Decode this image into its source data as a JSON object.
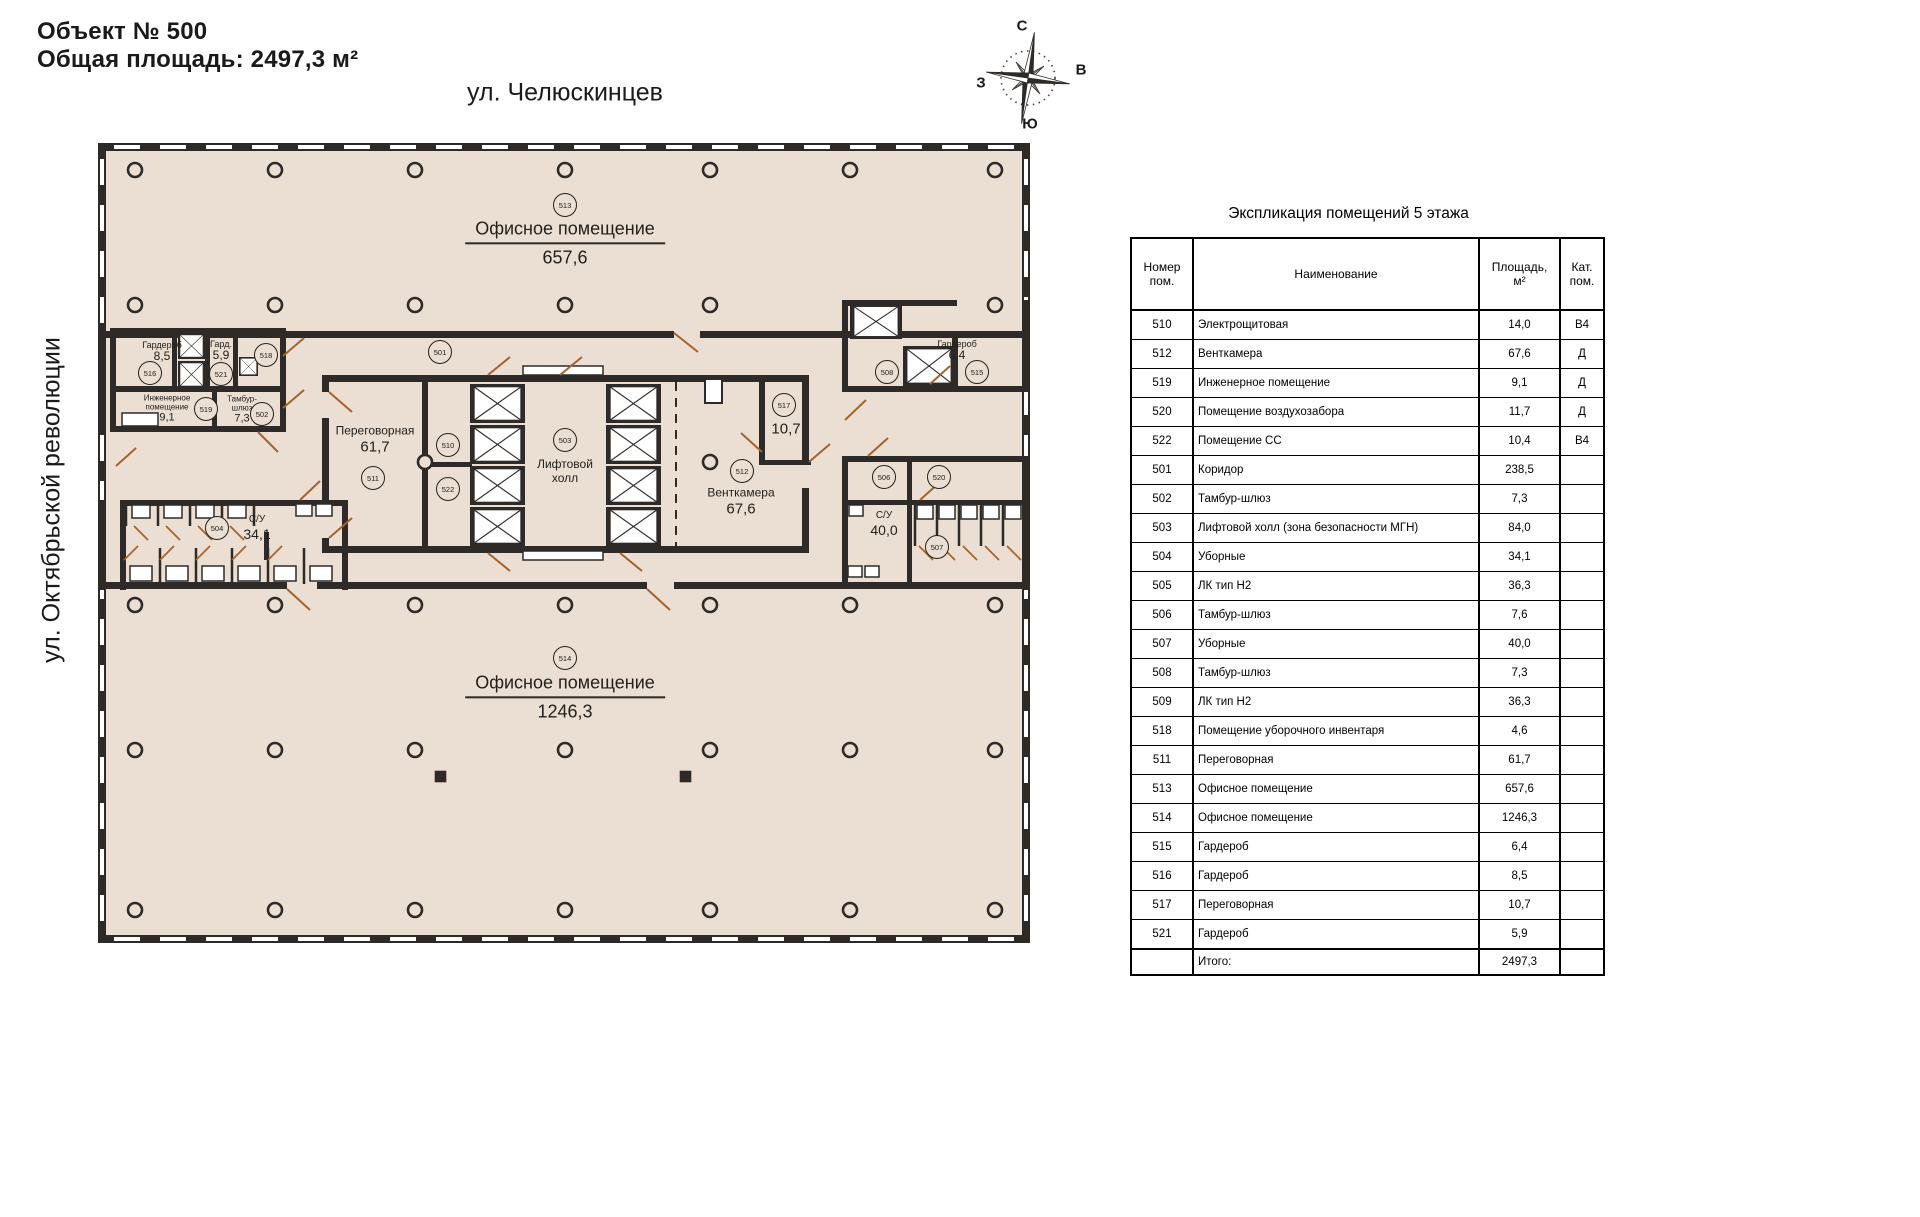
{
  "colors": {
    "floor": "#EADFD2",
    "wall": "#2E2A27",
    "door": "#A6622B",
    "paper": "#FFFFFF"
  },
  "header": {
    "title": "Объект № 500",
    "subtitle": "Общая площадь: 2497,3 м²"
  },
  "streets": {
    "top": "ул. Челюскинцев",
    "left": "ул. Октябрьской революции"
  },
  "compass": {
    "n": "С",
    "s": "Ю",
    "w": "З",
    "e": "В"
  },
  "plan": {
    "labels": [
      {
        "id": "513",
        "kind": "office",
        "x": 565,
        "y": 243,
        "name": "Офисное помещение",
        "area": "657,6",
        "underline": true
      },
      {
        "id": "514",
        "kind": "office",
        "x": 565,
        "y": 697,
        "name": "Офисное помещение",
        "area": "1246,3",
        "underline": true
      },
      {
        "id": "511",
        "kind": "room",
        "x": 375,
        "y": 440,
        "name": "Переговорная",
        "area": "61,7"
      },
      {
        "id": "503",
        "kind": "room",
        "x": 565,
        "y": 472,
        "name": "Лифтовой\nхолл"
      },
      {
        "id": "512",
        "kind": "room",
        "x": 741,
        "y": 502,
        "name": "Венткамера",
        "area": "67,6"
      },
      {
        "id": "517",
        "kind": "room",
        "x": 786,
        "y": 429,
        "area": "10,7"
      },
      {
        "id": "516",
        "kind": "tiny",
        "x": 162,
        "y": 352,
        "name": "Гардероб",
        "area": "8,5"
      },
      {
        "id": "521",
        "kind": "tiny",
        "x": 221,
        "y": 351,
        "name": "Гард.",
        "area": "5,9"
      },
      {
        "id": "519",
        "kind": "tiny2",
        "x": 167,
        "y": 409,
        "name": "Инженерное\nпомещение",
        "area": "9,1"
      },
      {
        "id": "502",
        "kind": "tiny2",
        "x": 242,
        "y": 410,
        "name": "Тамбур-\nшлюз",
        "area": "7,3"
      },
      {
        "id": "504",
        "kind": "small",
        "x": 257,
        "y": 528,
        "name": "С/У",
        "area": "34,1"
      },
      {
        "id": "507",
        "kind": "small",
        "x": 884,
        "y": 524,
        "name": "С/У",
        "area": "40,0"
      },
      {
        "id": "515",
        "kind": "tiny",
        "x": 957,
        "y": 351,
        "name": "Гардероб",
        "area": "6,4"
      }
    ],
    "badges": [
      {
        "num": "513",
        "x": 565,
        "y": 205
      },
      {
        "num": "514",
        "x": 565,
        "y": 658
      },
      {
        "num": "501",
        "x": 440,
        "y": 352
      },
      {
        "num": "511",
        "x": 373,
        "y": 478
      },
      {
        "num": "510",
        "x": 448,
        "y": 445
      },
      {
        "num": "522",
        "x": 448,
        "y": 489
      },
      {
        "num": "503",
        "x": 565,
        "y": 440
      },
      {
        "num": "512",
        "x": 742,
        "y": 471
      },
      {
        "num": "517",
        "x": 784,
        "y": 405
      },
      {
        "num": "516",
        "x": 150,
        "y": 373
      },
      {
        "num": "521",
        "x": 221,
        "y": 374
      },
      {
        "num": "518",
        "x": 266,
        "y": 355
      },
      {
        "num": "519",
        "x": 206,
        "y": 409
      },
      {
        "num": "502",
        "x": 262,
        "y": 414
      },
      {
        "num": "504",
        "x": 217,
        "y": 528
      },
      {
        "num": "506",
        "x": 884,
        "y": 477
      },
      {
        "num": "520",
        "x": 939,
        "y": 477
      },
      {
        "num": "507",
        "x": 937,
        "y": 547
      },
      {
        "num": "508",
        "x": 887,
        "y": 372
      },
      {
        "num": "515",
        "x": 977,
        "y": 372
      }
    ]
  },
  "table": {
    "title": "Экспликация помещений 5 этажа",
    "columns": {
      "num": "Номер\nпом.",
      "name": "Наименование",
      "area": "Площадь, м²",
      "cat": "Кат.\nпом."
    },
    "rows": [
      {
        "num": "510",
        "name": "Электрощитовая",
        "area": "14,0",
        "cat": "В4"
      },
      {
        "num": "512",
        "name": "Венткамера",
        "area": "67,6",
        "cat": "Д"
      },
      {
        "num": "519",
        "name": "Инженерное помещение",
        "area": "9,1",
        "cat": "Д"
      },
      {
        "num": "520",
        "name": "Помещение воздухозабора",
        "area": "11,7",
        "cat": "Д"
      },
      {
        "num": "522",
        "name": "Помещение СС",
        "area": "10,4",
        "cat": "В4"
      },
      {
        "num": "501",
        "name": "Коридор",
        "area": "238,5",
        "cat": ""
      },
      {
        "num": "502",
        "name": "Тамбур-шлюз",
        "area": "7,3",
        "cat": ""
      },
      {
        "num": "503",
        "name": "Лифтовой холл (зона безопасности МГН)",
        "area": "84,0",
        "cat": ""
      },
      {
        "num": "504",
        "name": "Уборные",
        "area": "34,1",
        "cat": ""
      },
      {
        "num": "505",
        "name": "ЛК тип Н2",
        "area": "36,3",
        "cat": ""
      },
      {
        "num": "506",
        "name": "Тамбур-шлюз",
        "area": "7,6",
        "cat": ""
      },
      {
        "num": "507",
        "name": "Уборные",
        "area": "40,0",
        "cat": ""
      },
      {
        "num": "508",
        "name": "Тамбур-шлюз",
        "area": "7,3",
        "cat": ""
      },
      {
        "num": "509",
        "name": "ЛК тип Н2",
        "area": "36,3",
        "cat": ""
      },
      {
        "num": "518",
        "name": "Помещение уборочного инвентаря",
        "area": "4,6",
        "cat": ""
      },
      {
        "num": "511",
        "name": "Переговорная",
        "area": "61,7",
        "cat": ""
      },
      {
        "num": "513",
        "name": "Офисное помещение",
        "area": "657,6",
        "cat": ""
      },
      {
        "num": "514",
        "name": "Офисное помещение",
        "area": "1246,3",
        "cat": ""
      },
      {
        "num": "515",
        "name": "Гардероб",
        "area": "6,4",
        "cat": ""
      },
      {
        "num": "516",
        "name": "Гардероб",
        "area": "8,5",
        "cat": ""
      },
      {
        "num": "517",
        "name": "Переговорная",
        "area": "10,7",
        "cat": ""
      },
      {
        "num": "521",
        "name": "Гардероб",
        "area": "5,9",
        "cat": ""
      }
    ],
    "total": {
      "label": "Итого:",
      "area": "2497,3"
    }
  }
}
